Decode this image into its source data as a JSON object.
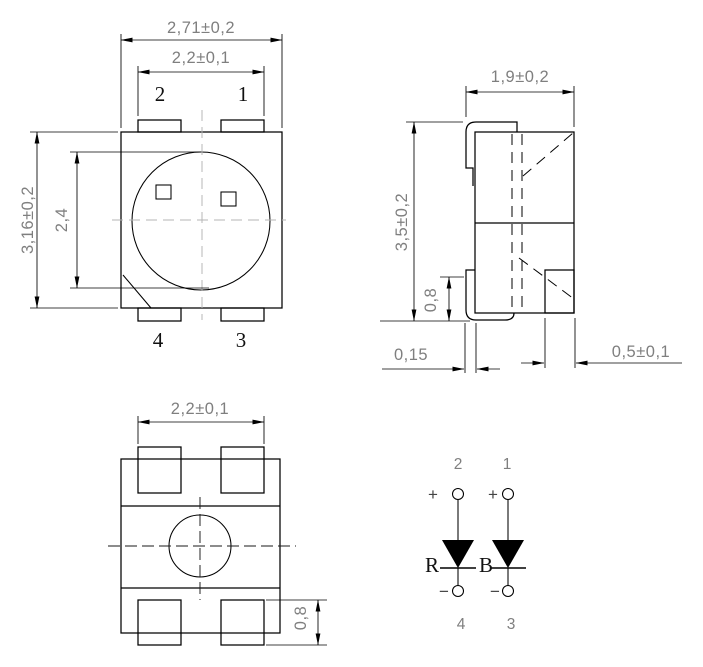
{
  "front": {
    "dims": {
      "outer_width": "2,71±0,2",
      "inner_width": "2,2±0,1",
      "outer_height": "3,16±0,2",
      "lens_height": "2,4"
    },
    "pins": {
      "top_left": "2",
      "top_right": "1",
      "bottom_left": "4",
      "bottom_right": "3"
    }
  },
  "side": {
    "dims": {
      "width": "1,9±0,2",
      "height": "3,5±0,2",
      "lead_height": "0,8",
      "lead_thickness": "0,15",
      "lead_width": "0,5±0,1"
    }
  },
  "bottom": {
    "dims": {
      "pad_span": "2,2±0,1",
      "pad_height": "0,8"
    }
  },
  "circuit": {
    "left": {
      "top_pin": "2",
      "bottom_pin": "4",
      "anode_sign": "+",
      "cathode_sign": "−",
      "label": "R"
    },
    "right": {
      "top_pin": "1",
      "bottom_pin": "3",
      "anode_sign": "+",
      "cathode_sign": "−",
      "label": "B"
    }
  },
  "colors": {
    "line": "#000000",
    "dim_text": "#7f7f7f",
    "front_centerline": "#b4b4b4",
    "pin_label": "#111111"
  }
}
